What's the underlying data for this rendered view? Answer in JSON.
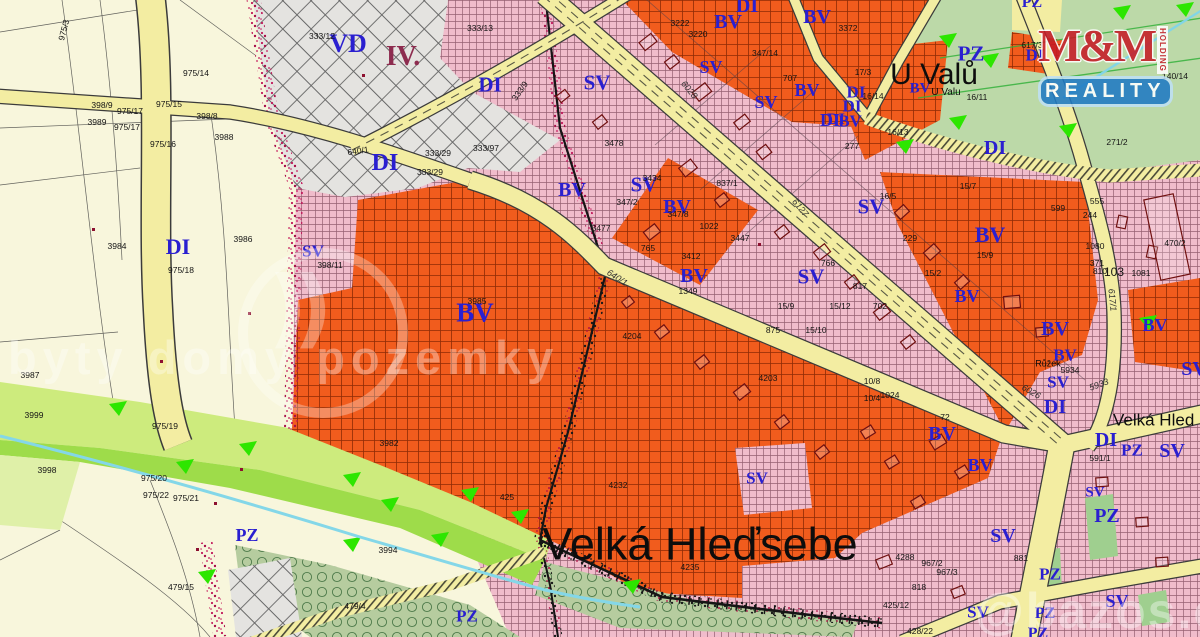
{
  "map": {
    "place": "Velká Hleďsebe",
    "title_labels": [
      {
        "t": "Velká Hleďsebe",
        "x": 700,
        "y": 544,
        "s": 45
      },
      {
        "t": "U Valů",
        "x": 934,
        "y": 75,
        "s": 30
      },
      {
        "t": "U Valu",
        "x": 946,
        "y": 93,
        "s": 10
      },
      {
        "t": "Velká Hled",
        "x": 1113,
        "y": 420,
        "s": 17,
        "a": "l"
      },
      {
        "t": "Růžek",
        "x": 1048,
        "y": 364,
        "s": 9
      }
    ],
    "district_label": {
      "t": "IV.",
      "x": 403,
      "y": 57
    },
    "zone_labels": [
      {
        "t": "VD",
        "x": 348,
        "y": 44,
        "s": 26
      },
      {
        "t": "DI",
        "x": 385,
        "y": 163,
        "s": 24
      },
      {
        "t": "DI",
        "x": 178,
        "y": 247,
        "s": 22
      },
      {
        "t": "DI",
        "x": 490,
        "y": 85,
        "s": 21
      },
      {
        "t": "DI",
        "x": 747,
        "y": 6,
        "s": 20
      },
      {
        "t": "DI",
        "x": 830,
        "y": 120,
        "s": 18
      },
      {
        "t": "DI",
        "x": 856,
        "y": 92,
        "s": 17
      },
      {
        "t": "DI",
        "x": 852,
        "y": 106,
        "s": 17
      },
      {
        "t": "DI",
        "x": 836,
        "y": 120,
        "s": 16
      },
      {
        "t": "DI",
        "x": 1035,
        "y": 55,
        "s": 17
      },
      {
        "t": "DI",
        "x": 995,
        "y": 148,
        "s": 20
      },
      {
        "t": "DI",
        "x": 1055,
        "y": 407,
        "s": 20
      },
      {
        "t": "DI",
        "x": 1106,
        "y": 440,
        "s": 20
      },
      {
        "t": "BV",
        "x": 728,
        "y": 22,
        "s": 20
      },
      {
        "t": "BV",
        "x": 817,
        "y": 17,
        "s": 20
      },
      {
        "t": "BV",
        "x": 807,
        "y": 90,
        "s": 18
      },
      {
        "t": "BV",
        "x": 920,
        "y": 89,
        "s": 15
      },
      {
        "t": "BV",
        "x": 850,
        "y": 121,
        "s": 17
      },
      {
        "t": "BV",
        "x": 572,
        "y": 190,
        "s": 20
      },
      {
        "t": "BV",
        "x": 677,
        "y": 207,
        "s": 20
      },
      {
        "t": "BV",
        "x": 475,
        "y": 313,
        "s": 27
      },
      {
        "t": "BV",
        "x": 694,
        "y": 276,
        "s": 20
      },
      {
        "t": "BV",
        "x": 990,
        "y": 235,
        "s": 22
      },
      {
        "t": "BV",
        "x": 967,
        "y": 296,
        "s": 18
      },
      {
        "t": "BV",
        "x": 1055,
        "y": 329,
        "s": 20
      },
      {
        "t": "BV",
        "x": 1155,
        "y": 325,
        "s": 18
      },
      {
        "t": "BV",
        "x": 1065,
        "y": 355,
        "s": 17
      },
      {
        "t": "BV",
        "x": 942,
        "y": 434,
        "s": 20
      },
      {
        "t": "BV",
        "x": 980,
        "y": 465,
        "s": 18
      },
      {
        "t": "SV",
        "x": 313,
        "y": 251,
        "s": 17
      },
      {
        "t": "SV",
        "x": 597,
        "y": 83,
        "s": 21
      },
      {
        "t": "SV",
        "x": 711,
        "y": 67,
        "s": 18
      },
      {
        "t": "SV",
        "x": 766,
        "y": 102,
        "s": 18
      },
      {
        "t": "SV",
        "x": 644,
        "y": 185,
        "s": 21
      },
      {
        "t": "SV",
        "x": 871,
        "y": 207,
        "s": 21
      },
      {
        "t": "SV",
        "x": 811,
        "y": 277,
        "s": 21
      },
      {
        "t": "SV",
        "x": 757,
        "y": 478,
        "s": 17
      },
      {
        "t": "SV",
        "x": 1058,
        "y": 382,
        "s": 17
      },
      {
        "t": "SV",
        "x": 1003,
        "y": 536,
        "s": 20
      },
      {
        "t": "SV",
        "x": 1095,
        "y": 493,
        "s": 15
      },
      {
        "t": "SV",
        "x": 1172,
        "y": 451,
        "s": 20
      },
      {
        "t": "SV",
        "x": 1117,
        "y": 601,
        "s": 18
      },
      {
        "t": "SV",
        "x": 978,
        "y": 612,
        "s": 17
      },
      {
        "t": "SV",
        "x": 1194,
        "y": 369,
        "s": 20
      },
      {
        "t": "PZ",
        "x": 971,
        "y": 54,
        "s": 21
      },
      {
        "t": "PZ",
        "x": 1032,
        "y": 3,
        "s": 16
      },
      {
        "t": "PZ",
        "x": 247,
        "y": 535,
        "s": 18
      },
      {
        "t": "PZ",
        "x": 467,
        "y": 616,
        "s": 17
      },
      {
        "t": "PZ",
        "x": 1107,
        "y": 516,
        "s": 20
      },
      {
        "t": "PZ",
        "x": 1050,
        "y": 574,
        "s": 17
      },
      {
        "t": "PZ",
        "x": 1132,
        "y": 450,
        "s": 17
      },
      {
        "t": "PZ",
        "x": 1045,
        "y": 614,
        "s": 16
      },
      {
        "t": "PZ",
        "x": 1038,
        "y": 634,
        "s": 16
      }
    ],
    "parcel_numbers": [
      {
        "t": "398/9",
        "x": 102,
        "y": 105
      },
      {
        "t": "975/17",
        "x": 130,
        "y": 111
      },
      {
        "t": "3989",
        "x": 97,
        "y": 122
      },
      {
        "t": "975/17",
        "x": 127,
        "y": 127
      },
      {
        "t": "398/8",
        "x": 207,
        "y": 116
      },
      {
        "t": "975/15",
        "x": 169,
        "y": 104
      },
      {
        "t": "3988",
        "x": 224,
        "y": 137
      },
      {
        "t": "975/16",
        "x": 163,
        "y": 144
      },
      {
        "t": "975/14",
        "x": 196,
        "y": 73
      },
      {
        "t": "975/3",
        "x": 64,
        "y": 30,
        "r": -75
      },
      {
        "t": "3984",
        "x": 117,
        "y": 246
      },
      {
        "t": "3986",
        "x": 243,
        "y": 239
      },
      {
        "t": "975/18",
        "x": 181,
        "y": 270
      },
      {
        "t": "3987",
        "x": 30,
        "y": 375
      },
      {
        "t": "3999",
        "x": 34,
        "y": 415
      },
      {
        "t": "975/19",
        "x": 165,
        "y": 426
      },
      {
        "t": "3998",
        "x": 47,
        "y": 470
      },
      {
        "t": "975/20",
        "x": 154,
        "y": 478
      },
      {
        "t": "975/22",
        "x": 156,
        "y": 495
      },
      {
        "t": "975/21",
        "x": 186,
        "y": 498
      },
      {
        "t": "479/15",
        "x": 181,
        "y": 587
      },
      {
        "t": "3994",
        "x": 388,
        "y": 550
      },
      {
        "t": "479/4",
        "x": 355,
        "y": 606
      },
      {
        "t": "398/11",
        "x": 330,
        "y": 265
      },
      {
        "t": "333/12",
        "x": 322,
        "y": 36
      },
      {
        "t": "333/13",
        "x": 480,
        "y": 28
      },
      {
        "t": "640/1",
        "x": 358,
        "y": 151,
        "r": -8
      },
      {
        "t": "333/29",
        "x": 438,
        "y": 153
      },
      {
        "t": "333/29",
        "x": 430,
        "y": 172
      },
      {
        "t": "333/9",
        "x": 520,
        "y": 91,
        "r": -55
      },
      {
        "t": "333/97",
        "x": 486,
        "y": 148
      },
      {
        "t": "3985",
        "x": 477,
        "y": 301
      },
      {
        "t": "3982",
        "x": 389,
        "y": 443
      },
      {
        "t": "425",
        "x": 507,
        "y": 497
      },
      {
        "t": "4232",
        "x": 618,
        "y": 485
      },
      {
        "t": "4204",
        "x": 632,
        "y": 336
      },
      {
        "t": "4235",
        "x": 690,
        "y": 567
      },
      {
        "t": "3478",
        "x": 614,
        "y": 143
      },
      {
        "t": "347/8",
        "x": 678,
        "y": 214
      },
      {
        "t": "3434",
        "x": 652,
        "y": 178
      },
      {
        "t": "347/2",
        "x": 627,
        "y": 202
      },
      {
        "t": "837/1",
        "x": 727,
        "y": 183
      },
      {
        "t": "3477",
        "x": 601,
        "y": 228
      },
      {
        "t": "1022",
        "x": 709,
        "y": 226
      },
      {
        "t": "3412",
        "x": 691,
        "y": 256
      },
      {
        "t": "765",
        "x": 648,
        "y": 248
      },
      {
        "t": "3447",
        "x": 740,
        "y": 238
      },
      {
        "t": "1349",
        "x": 688,
        "y": 291
      },
      {
        "t": "3372",
        "x": 848,
        "y": 28
      },
      {
        "t": "3222",
        "x": 680,
        "y": 23
      },
      {
        "t": "3220",
        "x": 698,
        "y": 34
      },
      {
        "t": "347/14",
        "x": 765,
        "y": 53
      },
      {
        "t": "707",
        "x": 790,
        "y": 78
      },
      {
        "t": "17/3",
        "x": 863,
        "y": 72
      },
      {
        "t": "16/14",
        "x": 873,
        "y": 96
      },
      {
        "t": "16/11",
        "x": 977,
        "y": 97
      },
      {
        "t": "16/13",
        "x": 898,
        "y": 132
      },
      {
        "t": "277",
        "x": 852,
        "y": 146
      },
      {
        "t": "617/3",
        "x": 1032,
        "y": 45
      },
      {
        "t": "140/14",
        "x": 1175,
        "y": 76
      },
      {
        "t": "271/2",
        "x": 1117,
        "y": 142
      },
      {
        "t": "599",
        "x": 1058,
        "y": 208
      },
      {
        "t": "555",
        "x": 1097,
        "y": 201
      },
      {
        "t": "244",
        "x": 1090,
        "y": 215
      },
      {
        "t": "1080",
        "x": 1095,
        "y": 246
      },
      {
        "t": "371",
        "x": 1097,
        "y": 263
      },
      {
        "t": "810",
        "x": 1100,
        "y": 271
      },
      {
        "t": "103",
        "x": 1114,
        "y": 272,
        "s": 12
      },
      {
        "t": "1081",
        "x": 1141,
        "y": 273
      },
      {
        "t": "470/2",
        "x": 1175,
        "y": 243
      },
      {
        "t": "16/5",
        "x": 888,
        "y": 196
      },
      {
        "t": "229",
        "x": 910,
        "y": 238
      },
      {
        "t": "766",
        "x": 828,
        "y": 263
      },
      {
        "t": "817",
        "x": 860,
        "y": 286
      },
      {
        "t": "15/12",
        "x": 840,
        "y": 306
      },
      {
        "t": "702",
        "x": 880,
        "y": 306
      },
      {
        "t": "15/9",
        "x": 786,
        "y": 306
      },
      {
        "t": "875",
        "x": 773,
        "y": 330
      },
      {
        "t": "15/10",
        "x": 816,
        "y": 330
      },
      {
        "t": "15/2",
        "x": 933,
        "y": 273
      },
      {
        "t": "15/9",
        "x": 985,
        "y": 255
      },
      {
        "t": "15/7",
        "x": 968,
        "y": 186
      },
      {
        "t": "10/8",
        "x": 872,
        "y": 381
      },
      {
        "t": "10/4",
        "x": 872,
        "y": 398
      },
      {
        "t": "4203",
        "x": 768,
        "y": 378
      },
      {
        "t": "72",
        "x": 945,
        "y": 417
      },
      {
        "t": "1024",
        "x": 890,
        "y": 395
      },
      {
        "t": "5934",
        "x": 1070,
        "y": 370
      },
      {
        "t": "591/1",
        "x": 1100,
        "y": 458
      },
      {
        "t": "967/2",
        "x": 932,
        "y": 563
      },
      {
        "t": "967/3",
        "x": 947,
        "y": 572
      },
      {
        "t": "4288",
        "x": 905,
        "y": 557
      },
      {
        "t": "818",
        "x": 919,
        "y": 587
      },
      {
        "t": "881",
        "x": 1021,
        "y": 558
      },
      {
        "t": "425/12",
        "x": 896,
        "y": 605
      },
      {
        "t": "428/22",
        "x": 920,
        "y": 631
      }
    ],
    "road_numbers": [
      {
        "t": "6028",
        "x": 689,
        "y": 90,
        "r": 50
      },
      {
        "t": "6127",
        "x": 800,
        "y": 208,
        "r": 50
      },
      {
        "t": "640/1",
        "x": 617,
        "y": 278,
        "r": 33
      },
      {
        "t": "6026",
        "x": 1031,
        "y": 392,
        "r": 30
      },
      {
        "t": "617/1",
        "x": 1112,
        "y": 300,
        "r": 84
      },
      {
        "t": "5933",
        "x": 1099,
        "y": 385,
        "r": -20
      }
    ],
    "zone_colors": {
      "SV": "#f0bccb",
      "BV": "#f15c1d",
      "VD": "#e4e3e0",
      "PZ": "#b9cfa2",
      "road": "#f3eda2",
      "label_blue": "#2a1fd0"
    }
  },
  "watermark": {
    "brand": "M&M",
    "holding": "HOLDING",
    "reality": "REALITY",
    "center_text": "byty domy pozemky",
    "corner_text": "@bazos.cz"
  }
}
